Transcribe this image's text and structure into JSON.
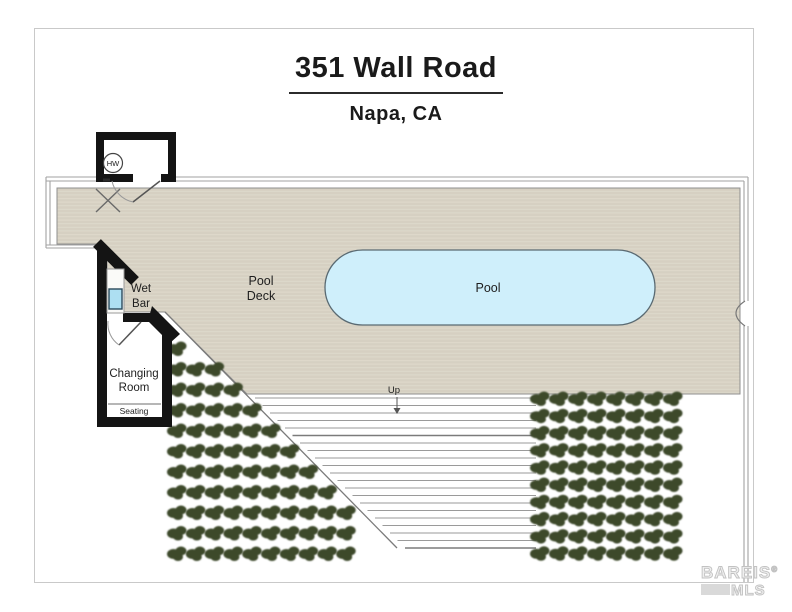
{
  "header": {
    "title": "351 Wall Road",
    "subtitle": "Napa, CA"
  },
  "plan": {
    "labels": {
      "pool": "Pool",
      "pool_deck_line1": "Pool",
      "pool_deck_line2": "Deck",
      "wet_bar_line1": "Wet",
      "wet_bar_line2": "Bar",
      "changing_room_line1": "Changing",
      "changing_room_line2": "Room",
      "seating": "Seating",
      "water_heater": "HW",
      "stairs_up": "Up"
    },
    "stairs": {
      "y_start": 398,
      "y_end": 548,
      "count": 21,
      "x_right": 536,
      "diag_offset": 147,
      "x_min": 251
    },
    "plants": {
      "left": {
        "x0": 177,
        "dx": 18.8,
        "cols": 10,
        "y0": 348,
        "dy": 20.5,
        "rows": 11,
        "diag_min_offset": 153
      },
      "right": {
        "x0": 540,
        "dx": 19,
        "cols": 8,
        "y0": 398,
        "dy": 17.2,
        "rows": 10
      }
    }
  },
  "colors": {
    "deck": "#d6d0c2",
    "deck_stripe": "#ded9cb",
    "pool_water": "#cfeffb",
    "pool_border": "#5a6a72",
    "shrub": "#3d4a2b",
    "wall": "#141414",
    "boundary_line": "#a2a2a2",
    "sink_water": "#addff2"
  },
  "watermark": {
    "name": "BAREIS",
    "registered": "®",
    "sub": "MLS"
  }
}
